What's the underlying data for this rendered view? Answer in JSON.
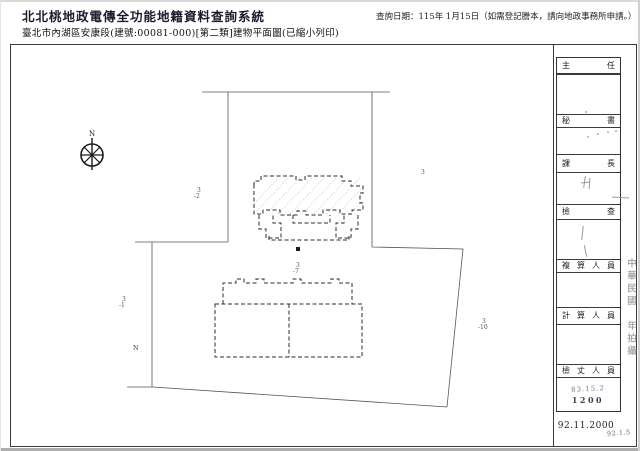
{
  "header": {
    "system_title": "北北桃地政電傳全功能地籍資料查詢系統",
    "query_date": "查詢日期：115年 1月15日（如需登記謄本，請向地政事務所申請。）",
    "subtitle": "臺北市內湖區安康段(建號:00081-000)[第二類]建物平面圖(已縮小列印)"
  },
  "map_labels": {
    "compass_n": "N",
    "lot_3": "3",
    "lot_3_2_num": "3",
    "lot_3_2_sub": "-2",
    "lot_3_7_num": "3",
    "lot_3_7_sub": "-7",
    "lot_3_1_num": "3",
    "lot_3_1_sub": "-1",
    "lot_3_10_num": "3",
    "lot_3_10_sub": "-10",
    "mark_n": "N"
  },
  "side_panel": {
    "rows": [
      {
        "label": "主 任"
      },
      {
        "label": "秘 書"
      },
      {
        "label": "課 長"
      },
      {
        "label": "檢 查"
      },
      {
        "label": "複 算 人 員"
      },
      {
        "label": "計 算 人 員"
      },
      {
        "label": "檢 丈 人 員"
      }
    ],
    "stamp_line1": "83.15.2",
    "stamp_line2": "1200",
    "photo_note": "中華民國　年拍攝",
    "print_date": "92.11.2000",
    "corner_mark": "92.1.5"
  },
  "colors": {
    "frame": "#3a3a3a",
    "lot_label": "#555555",
    "stamp_faint": "#8b95a5",
    "stamp_dark": "#3a4250",
    "title_ink": "#1c1c30"
  }
}
